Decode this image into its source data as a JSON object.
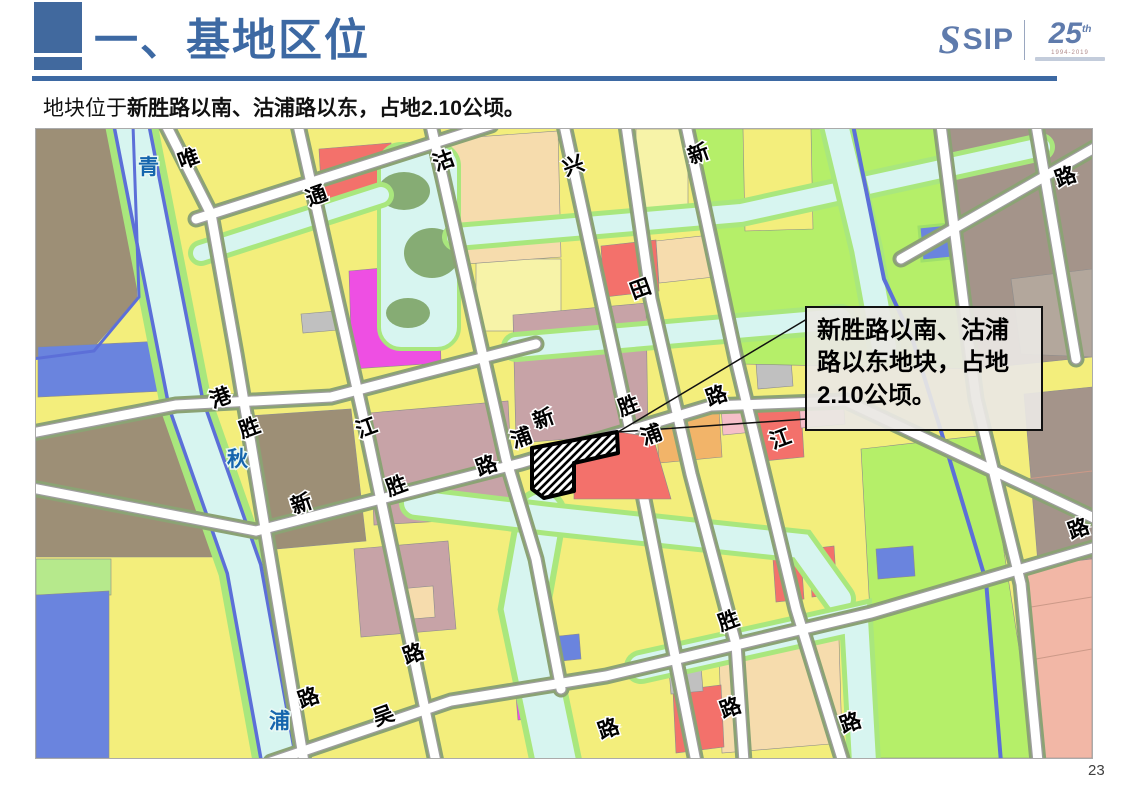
{
  "colors": {
    "accent": "#3d69a3",
    "accent2": "#41699e",
    "logo": "#5f7bac",
    "yellow": "#f3ee7c",
    "pale": "#f7f3a8",
    "olive": "#8ba374",
    "canal": "#d7f5f0",
    "bank": "#a9e77d",
    "green": "#b5ef69",
    "brown": "#9d8f76",
    "brown2": "#a4948a",
    "brown3": "#b3a79c",
    "mauve": "#c7a3a7",
    "red": "#f3716b",
    "magenta": "#ee4fe3",
    "bluep": "#6a84de",
    "stream": "#5c6fd8",
    "wheat": "#f6dcad",
    "orange": "#f2b469",
    "pink": "#f6bfc9",
    "salmon": "#f2b7a6",
    "gray": "#c0c0c0",
    "waterlabel": "#1565ad"
  },
  "header": {
    "title": "一、基地区位",
    "logo": {
      "swirl": "S",
      "sip": "SIP",
      "anniversary": "25",
      "anniv_sup": "th",
      "fineprint": "1994-2019"
    }
  },
  "subtitle": {
    "prefix": "地块位于",
    "bold": "新胜路以南、沽浦路以东，占地2.10公顷。"
  },
  "map": {
    "callout": {
      "lines": [
        "新胜路以南、沽浦",
        "路以东地块，占地",
        "2.10公顷。"
      ]
    },
    "road_labels": [
      {
        "ch": "唯",
        "x": 145,
        "y": 40,
        "rot": -20
      },
      {
        "ch": "通",
        "x": 273,
        "y": 77,
        "rot": -20
      },
      {
        "ch": "沽",
        "x": 400,
        "y": 42,
        "rot": -20
      },
      {
        "ch": "兴",
        "x": 530,
        "y": 47,
        "rot": -20
      },
      {
        "ch": "新",
        "x": 655,
        "y": 35,
        "rot": -20
      },
      {
        "ch": "路",
        "x": 1022,
        "y": 58,
        "rot": -20
      },
      {
        "ch": "田",
        "x": 597,
        "y": 170,
        "rot": -20
      },
      {
        "ch": "港",
        "x": 177,
        "y": 279,
        "rot": -20
      },
      {
        "ch": "胜",
        "x": 206,
        "y": 309,
        "rot": -20
      },
      {
        "ch": "江",
        "x": 323,
        "y": 309,
        "rot": -20
      },
      {
        "ch": "新",
        "x": 258,
        "y": 385,
        "rot": -20
      },
      {
        "ch": "胜",
        "x": 353,
        "y": 367,
        "rot": -20
      },
      {
        "ch": "路",
        "x": 443,
        "y": 347,
        "rot": -20
      },
      {
        "ch": "浦",
        "x": 478,
        "y": 319,
        "rot": -20
      },
      {
        "ch": "新",
        "x": 500,
        "y": 300,
        "rot": -20
      },
      {
        "ch": "胜",
        "x": 585,
        "y": 287,
        "rot": -20
      },
      {
        "ch": "路",
        "x": 673,
        "y": 277,
        "rot": -20
      },
      {
        "ch": "浦",
        "x": 608,
        "y": 316,
        "rot": -20
      },
      {
        "ch": "江",
        "x": 737,
        "y": 320,
        "rot": -20
      },
      {
        "ch": "路",
        "x": 1035,
        "y": 410,
        "rot": -20
      },
      {
        "ch": "路",
        "x": 265,
        "y": 579,
        "rot": -20
      },
      {
        "ch": "吴",
        "x": 340,
        "y": 597,
        "rot": -20
      },
      {
        "ch": "路",
        "x": 370,
        "y": 535,
        "rot": -20
      },
      {
        "ch": "路",
        "x": 565,
        "y": 610,
        "rot": -20
      },
      {
        "ch": "胜",
        "x": 685,
        "y": 502,
        "rot": -20
      },
      {
        "ch": "路",
        "x": 687,
        "y": 589,
        "rot": -20
      },
      {
        "ch": "路",
        "x": 807,
        "y": 604,
        "rot": -20
      }
    ],
    "water_labels": [
      {
        "ch": "青",
        "x": 102,
        "y": 45,
        "kind": "water"
      },
      {
        "ch": "秋",
        "x": 191,
        "y": 337,
        "kind": "water"
      },
      {
        "ch": "浦",
        "x": 233,
        "y": 599,
        "kind": "water"
      }
    ]
  },
  "page": {
    "number": "23"
  }
}
